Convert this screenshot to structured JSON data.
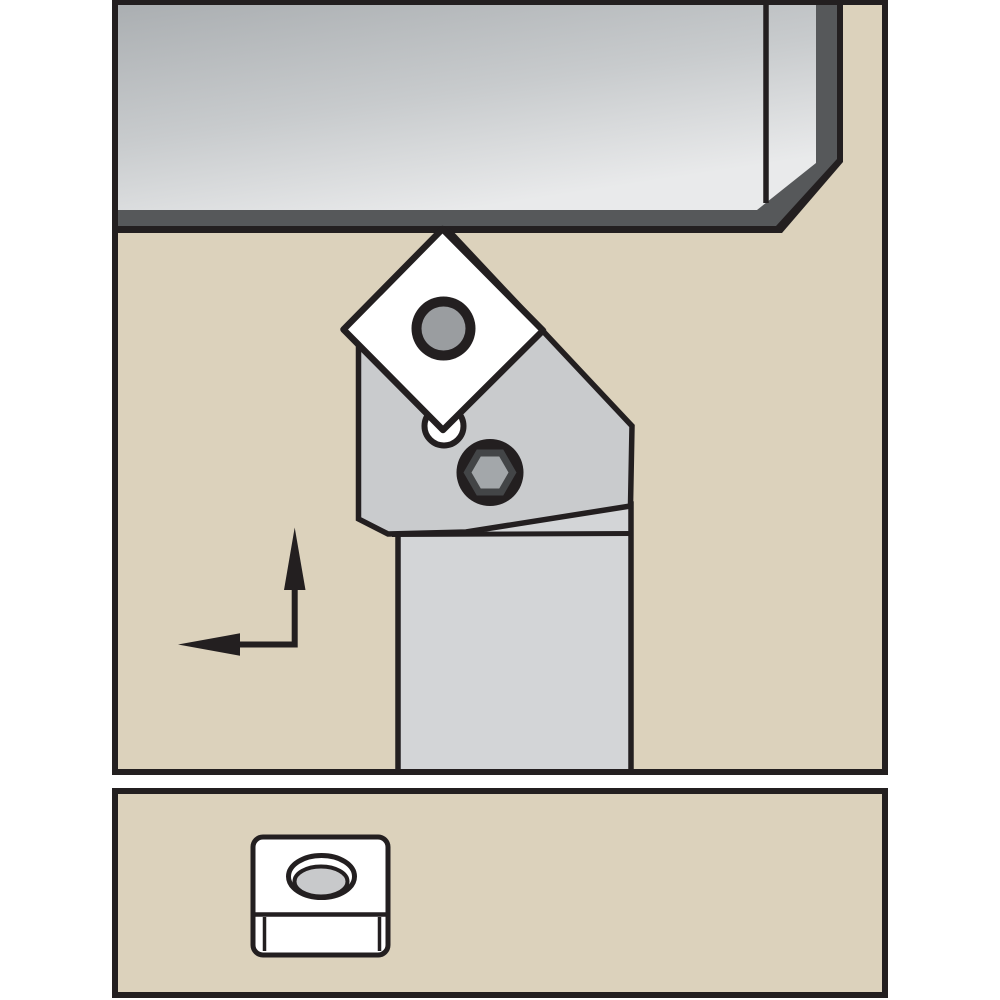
{
  "colors": {
    "page_bg": "#ffffff",
    "ink": "#231f20",
    "panel_tan": "#dcd2bc",
    "white": "#ffffff",
    "workpiece_edge_dark": "#56585a",
    "steel_top": "#a9adb0",
    "steel_mid": "#c8cbcd",
    "steel_bottom": "#e9eaeb",
    "head_gray": "#c9cbcd",
    "shank_gray": "#d3d5d7",
    "insert_hole_gray": "#9a9da0",
    "screw_socket_ring": "#434547",
    "screw_hex_gray": "#a3a7aa",
    "detail_hole_gray": "#c8c9cb"
  },
  "components": {
    "main_panel": "machining-scene-panel",
    "workpiece": "workpiece-bar",
    "tool_holder": "turning-tool-holder",
    "tool_head": "tool-holder-head",
    "tool_shank": "tool-holder-shank",
    "insert": "square-insert-rotated-45",
    "insert_hole": "insert-center-hole",
    "seat_pin": "insert-seat-pin",
    "clamp_screw": "hex-socket-clamp-screw",
    "arrows": "feed-direction-arrows",
    "detail_panel": "insert-detail-panel",
    "detail_insert": "square-insert-3d-view",
    "detail_insert_hole": "countersunk-insert-hole"
  }
}
